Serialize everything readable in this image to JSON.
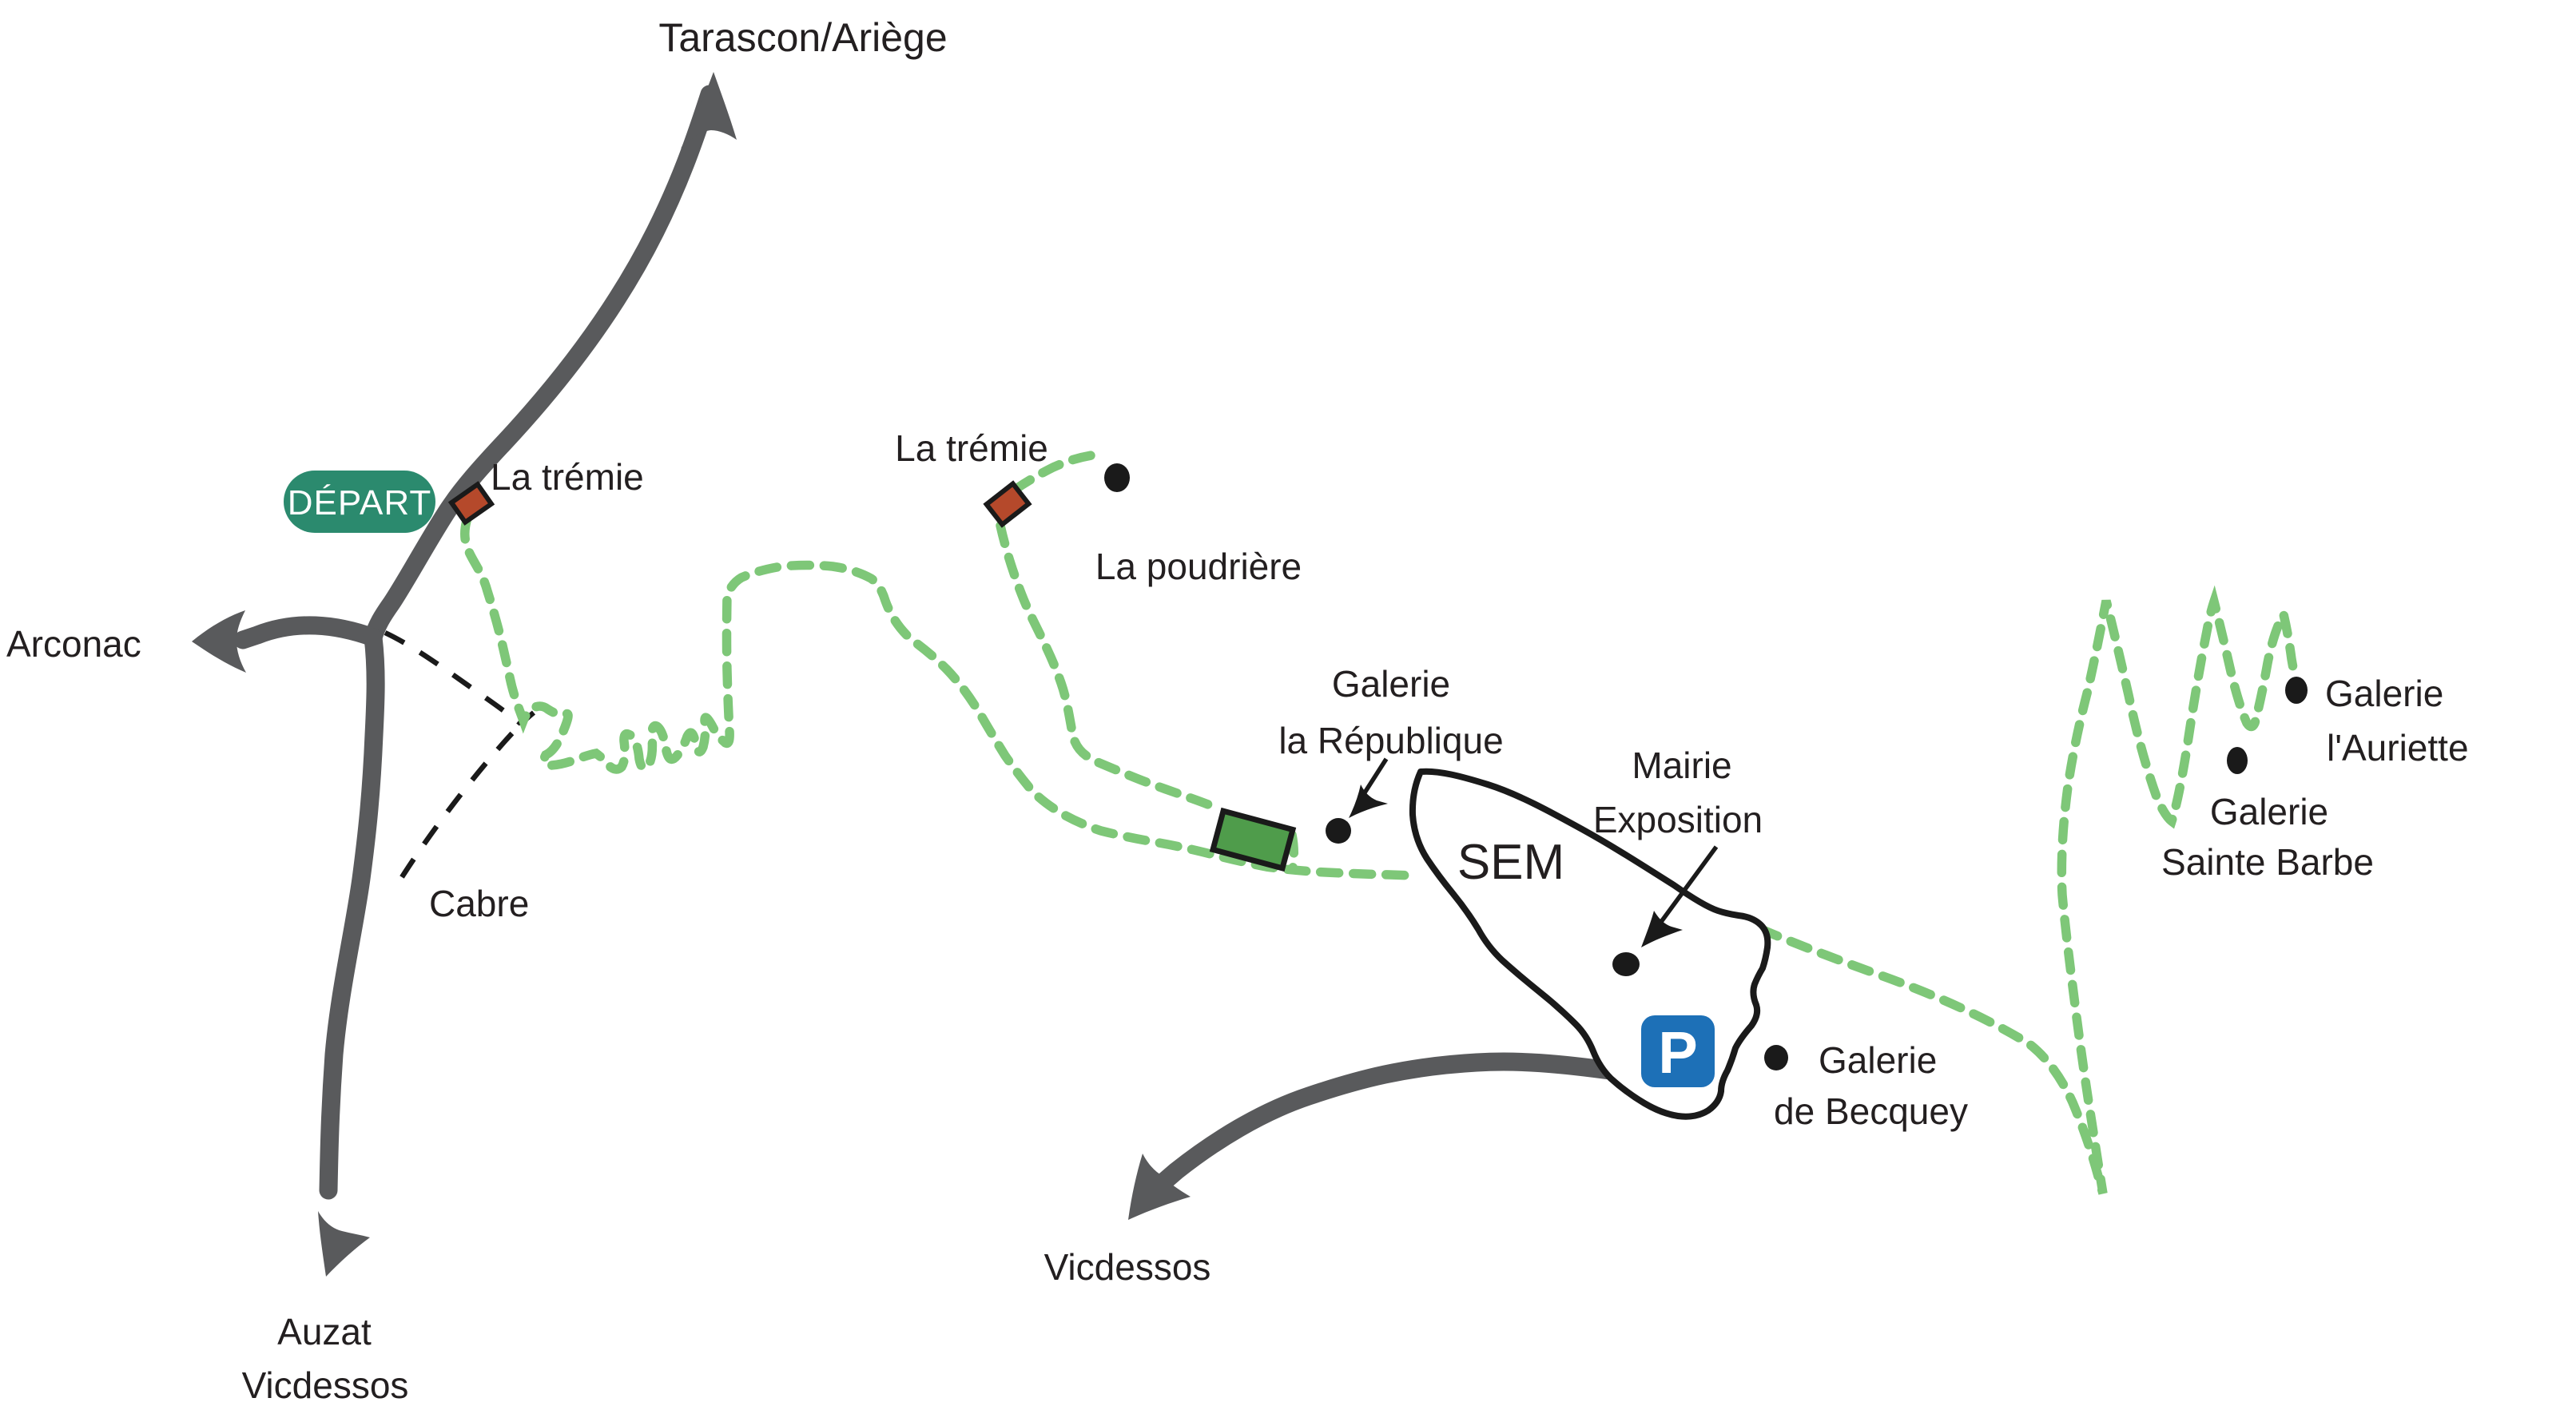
{
  "colors": {
    "road": "#595a5c",
    "trail": "#7ec778",
    "badge": "#2b8a6e",
    "marker_red": "#b5492b",
    "marker_green": "#4f9c4b",
    "parking_blue": "#1d70b7",
    "ink": "#231f20"
  },
  "destinations": {
    "north": "Tarascon/Ariège",
    "west": "Arconac",
    "southwest_line1": "Auzat",
    "southwest_line2": "Vicdessos",
    "south": "Vicdessos"
  },
  "start_badge": "DÉPART",
  "places": {
    "cabre": "Cabre",
    "tremie1": "La trémie",
    "tremie2": "La trémie",
    "poudriere": "La poudrière",
    "galerie_republique_l1": "Galerie",
    "galerie_republique_l2": "la République",
    "sem": "SEM",
    "mairie_l1": "Mairie",
    "mairie_l2": "Exposition",
    "becquey_l1": "Galerie",
    "becquey_l2": "de Becquey",
    "auriette_l1": "Galerie",
    "auriette_l2": "l'Auriette",
    "sainte_barbe_l1": "Galerie",
    "sainte_barbe_l2": "Sainte Barbe",
    "parking": "P"
  },
  "legend": {
    "trail_style": "green-dashed",
    "road_style": "solid-gray",
    "shortcut_style": "black-dashed"
  }
}
